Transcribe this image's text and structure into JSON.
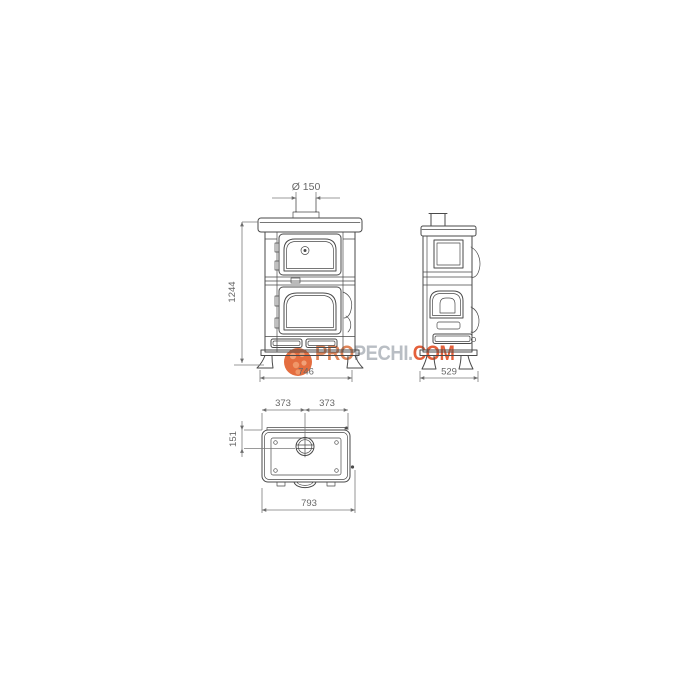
{
  "canvas": {
    "background": "#ffffff"
  },
  "drawing": {
    "line_color": "#4a4a4a",
    "dimension_color": "#6e6e6e",
    "front_view": {
      "flue_diameter": "Ø 150",
      "height": "1244",
      "width": "746"
    },
    "side_view": {
      "depth": "529"
    },
    "top_view": {
      "left_half": "373",
      "right_half": "373",
      "flue_offset": "151",
      "overall_width": "793"
    }
  },
  "watermark": {
    "prefix": "PRO",
    "middle": "PECHI.",
    "suffix": "COM",
    "logo_color": "#e2612f",
    "prefix_color": "#dd7a4a",
    "middle_color": "#b4b9bf",
    "suffix_color": "#e2532b"
  }
}
